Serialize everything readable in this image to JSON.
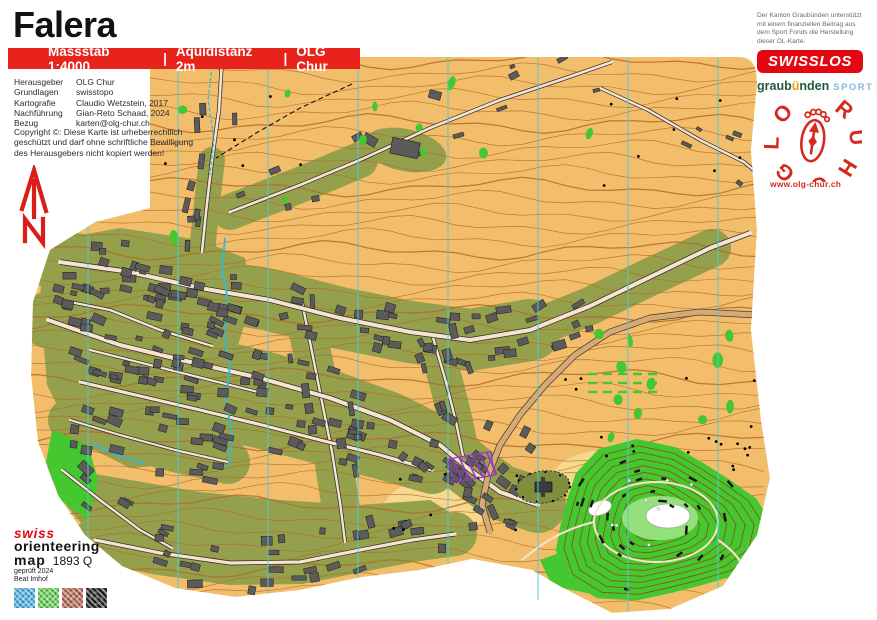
{
  "title": "Falera",
  "info_bar": {
    "scale": "Massstab 1:4000",
    "separator": "|",
    "equidistance": "Äquidistanz 2m",
    "club": "OLG Chur"
  },
  "credits": {
    "rows": [
      {
        "label": "Herausgeber",
        "value": "OLG Chur"
      },
      {
        "label": "Grundlagen",
        "value": "swisstopo"
      },
      {
        "label": "Kartografie",
        "value": "Claudio Wetzstein, 2017"
      },
      {
        "label": "Nachführung",
        "value": "Gian-Reto Schaad, 2024"
      },
      {
        "label": "Bezug",
        "value": "karten@olg-chur.ch"
      }
    ]
  },
  "copyright": {
    "lines": [
      "Copyright ©: Diese Karte ist urheberrechtlich",
      "geschützt und darf ohne schriftliche Bewilligung",
      "des Herausgebers nicht kopiert werden!"
    ]
  },
  "sponsor": {
    "note": "Der Kanton Graubünden unterstützt mit einem finanziellen Beitrag aus dem Sport Fonds die Herstellung dieser OL-Karte.",
    "swisslos": "SWISSLOS",
    "graubuenden": {
      "part1": "graub",
      "umlaut": "ü",
      "part2": "nden",
      "sport": "SPORT"
    },
    "olg_logo": {
      "left": [
        "O",
        "L",
        "G"
      ],
      "right": [
        "C",
        "H",
        "U",
        "R"
      ]
    },
    "website": "www.olg-chur.ch"
  },
  "footer": {
    "brand_swiss": "swiss",
    "brand_orienteering": "orienteering",
    "brand_map": "map",
    "map_number": "1893 Q",
    "checked": "geprüft 2024",
    "checker": "Beat Imhof",
    "color_patches": [
      "#4fb4e8",
      "#66d455",
      "#bb6a55",
      "#232323"
    ]
  },
  "map": {
    "palette": {
      "open_land": "#f3be6c",
      "open_yellow": "#f6d88e",
      "settlement_olive": "#94a04c",
      "forest_green": "#44c72f",
      "light_green": "#93e07c",
      "building": "#5b5b5b",
      "road_fill": "#f7e3cf",
      "road_major": "#d4ab76",
      "contour": "#b46a28",
      "hill_contour": "#8a4e16",
      "water": "#2fbbd6",
      "meridian": "#52cbd3",
      "purple": "#9b30d0",
      "cliff": "#111111"
    }
  }
}
